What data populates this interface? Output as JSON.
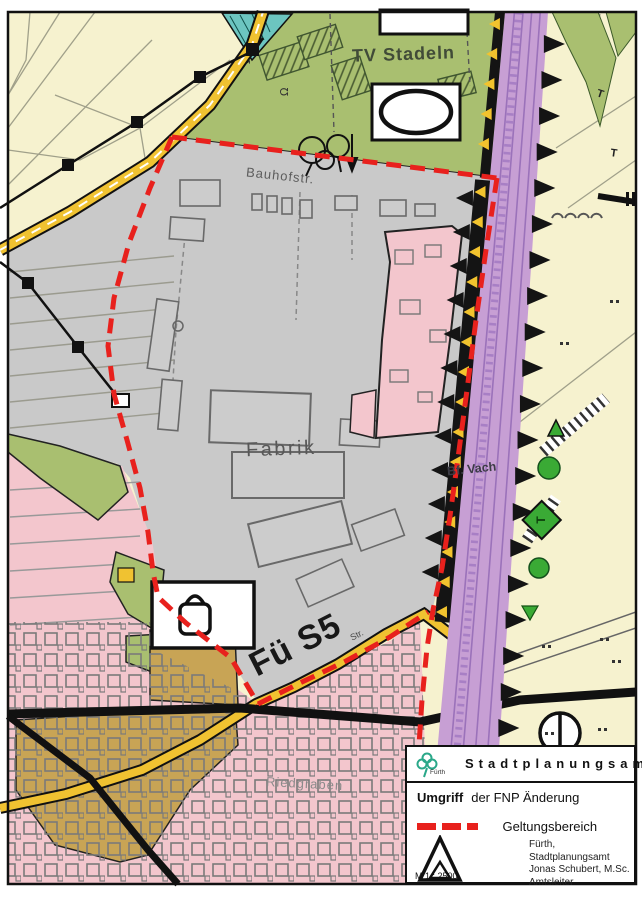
{
  "map": {
    "labels": {
      "sports_club": "TV Stadeln",
      "street_north": "Bauhofstr.",
      "factory": "Fabrik",
      "plan_code": "Fü S5",
      "street_suffix": "Str.",
      "station": "Bf. Vach",
      "district_south": "Riedgraben"
    },
    "colors": {
      "boundary_red": "#e8211d",
      "fields_cream": "#f6f2cf",
      "sports_green": "#a9bf70",
      "industrial_gray": "#c9c9c9",
      "residential_pink": "#f3c6cd",
      "mixed_khaki": "#c8a455",
      "railway_purple": "#c79fd4",
      "road_yellow": "#f0c231",
      "water_teal": "#6cc5c0",
      "tree_green": "#3aaa35"
    }
  },
  "legend": {
    "logo_label": "Fürth",
    "agency": "Stadtplanungsamt",
    "title_bold": "Umgriff",
    "title_rest": "der  FNP Änderung",
    "boundary_label": "Geltungsbereich",
    "scale": "M 1 : 2500",
    "issuer": [
      "Fürth,",
      "Stadtplanungsamt"
    ],
    "signatory": [
      "Jonas Schubert, M.Sc.",
      "Amtsleiter"
    ]
  }
}
